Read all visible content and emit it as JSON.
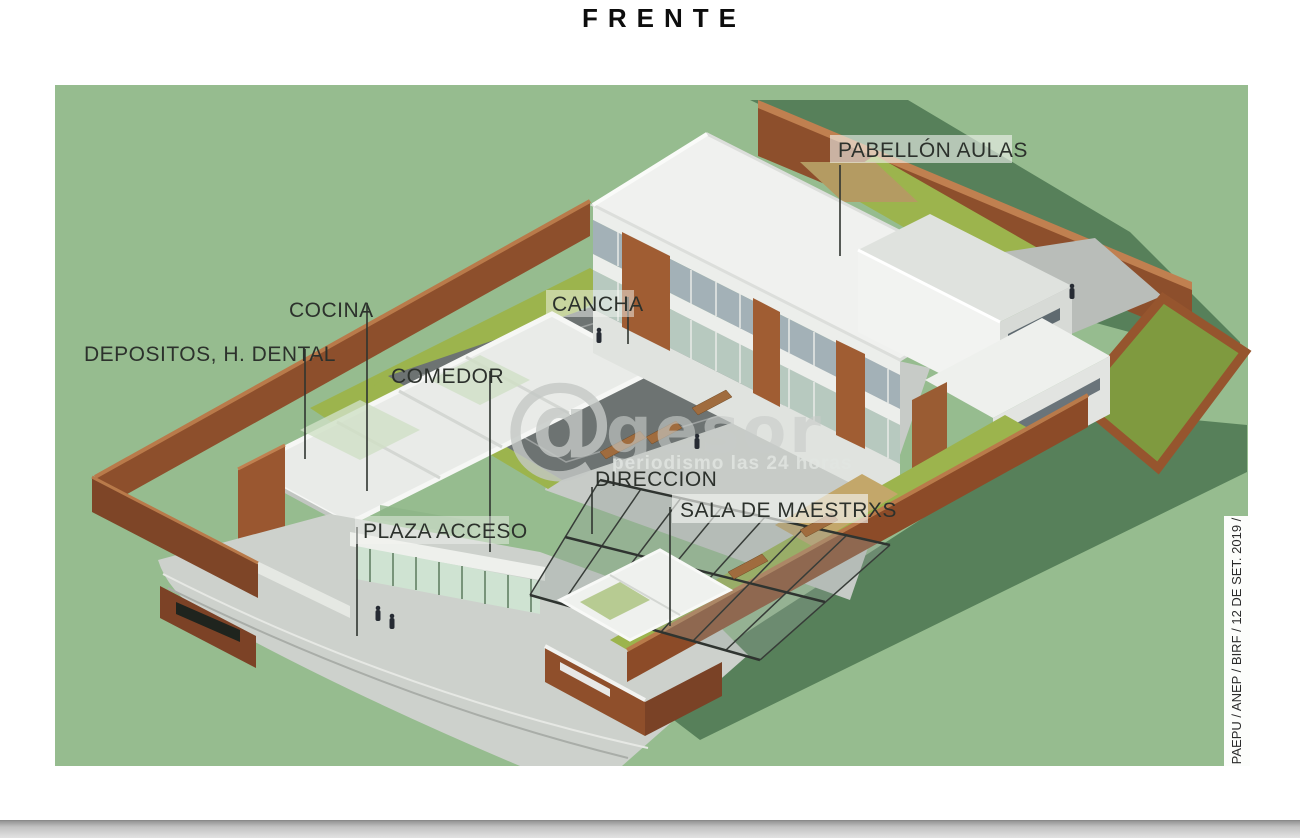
{
  "title": "FRENTE",
  "labels": {
    "pabellon_aulas": "PABELLÓN AULAS",
    "cancha": "CANCHA",
    "cocina": "COCINA",
    "depositos_h_dental": "DEPOSITOS, H. DENTAL",
    "comedor": "COMEDOR",
    "direccion": "DIRECCION",
    "sala_de_maestrxs": "SALA DE MAESTRXS",
    "plaza_acceso": "PLAZA ACCESO"
  },
  "watermark": {
    "symbol": "@",
    "name": "gesor",
    "tagline": "periodismo las 24 horas"
  },
  "side_caption": "PAEPU / ANEP / BIRF / 12 DE SET. 2019 /",
  "colors": {
    "background_green": "#96bc8f",
    "shadow_green": "#57805a",
    "grass_olive": "#9cb44d",
    "brick": "#8d4f2c",
    "court_gray": "#6d7372",
    "concrete_gray": "#c7cbc7",
    "building_white": "#f2f3f1",
    "label_text": "#2c312c"
  }
}
